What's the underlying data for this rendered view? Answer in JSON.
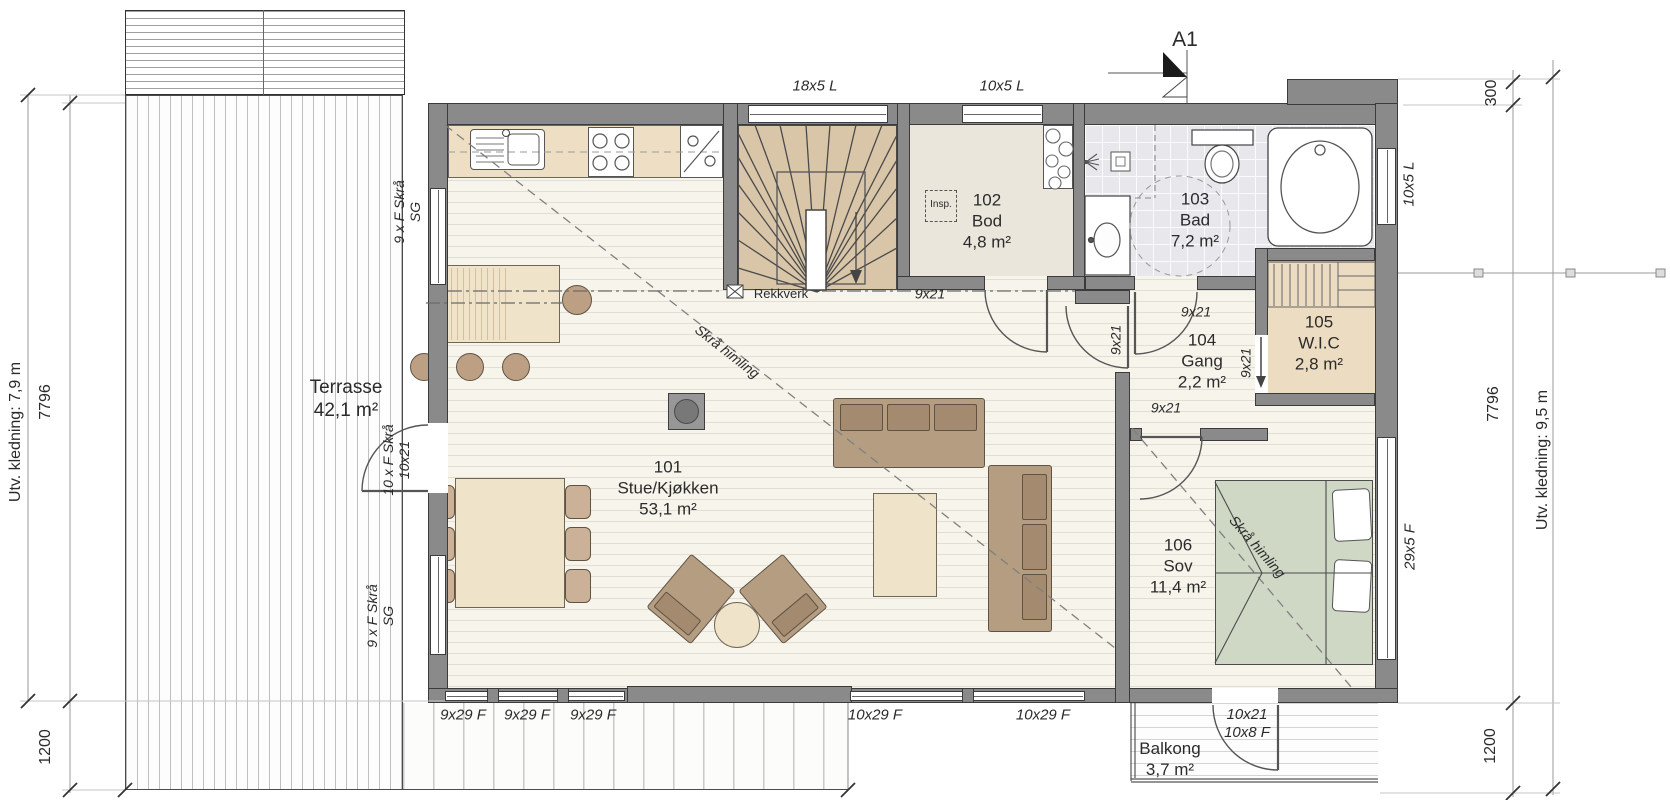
{
  "section_marker": "A1",
  "rooms": [
    {
      "number": "101",
      "name": "Stue/Kjøkken",
      "area": "53,1 m²"
    },
    {
      "number": "102",
      "name": "Bod",
      "area": "4,8 m²"
    },
    {
      "number": "103",
      "name": "Bad",
      "area": "7,2 m²"
    },
    {
      "number": "104",
      "name": "Gang",
      "area": "2,2 m²"
    },
    {
      "number": "105",
      "name": "W.I.C",
      "area": "2,8 m²"
    },
    {
      "number": "106",
      "name": "Sov",
      "area": "11,4 m²"
    }
  ],
  "outdoor": {
    "terrasse": {
      "name": "Terrasse",
      "area": "42,1 m²"
    },
    "balkong": {
      "name": "Balkong",
      "area": "3,7 m²"
    }
  },
  "dimensions": {
    "left": {
      "cladding": "Utv. kledning: 7,9 m",
      "height": "7796",
      "deck": "1200"
    },
    "right": {
      "cladding": "Utv. kledning: 9,5 m",
      "step": "300",
      "height": "7796",
      "deck": "1200"
    }
  },
  "windows": {
    "top_1": "18x5 L",
    "top_2": "10x5 L",
    "right_1": "10x5 L",
    "right_2": "29x5 F",
    "bottom_1": "9x29 F",
    "bottom_2": "9x29 F",
    "bottom_3": "9x29 F",
    "bottom_4": "10x29 F",
    "bottom_5": "10x29 F",
    "left_top_line1": "9 x F Skrå",
    "left_top_line2": "SG",
    "left_bottom_line1": "9 x F Skrå",
    "left_bottom_line2": "SG"
  },
  "doors": {
    "terrace_line1": "10 x F Skrå",
    "terrace_line2": "10x21",
    "bod": "9x21",
    "bad": "9x21",
    "hall": "9x21",
    "wic": "9x21",
    "sov": "9x21",
    "balcony_line1": "10x21",
    "balcony_line2": "10x8 F"
  },
  "annotations": {
    "railing": "Rekkverk",
    "inspection": "Insp.",
    "sloped_ceiling_living": "Skrå himling",
    "sloped_ceiling_bedroom": "Skrå himling"
  },
  "colors": {
    "wall": "#8a8a8a",
    "wood_floor": "#f7f4ec",
    "stair_floor": "#d9c6a9",
    "storage_floor": "#eae6db",
    "wic_floor": "#ecdcc1",
    "bath_tile": "#e8e8ec",
    "bed": "#cfd8c5",
    "sofa": "#b59d82",
    "table": "#efe3ca",
    "text": "#2b2b2b"
  }
}
